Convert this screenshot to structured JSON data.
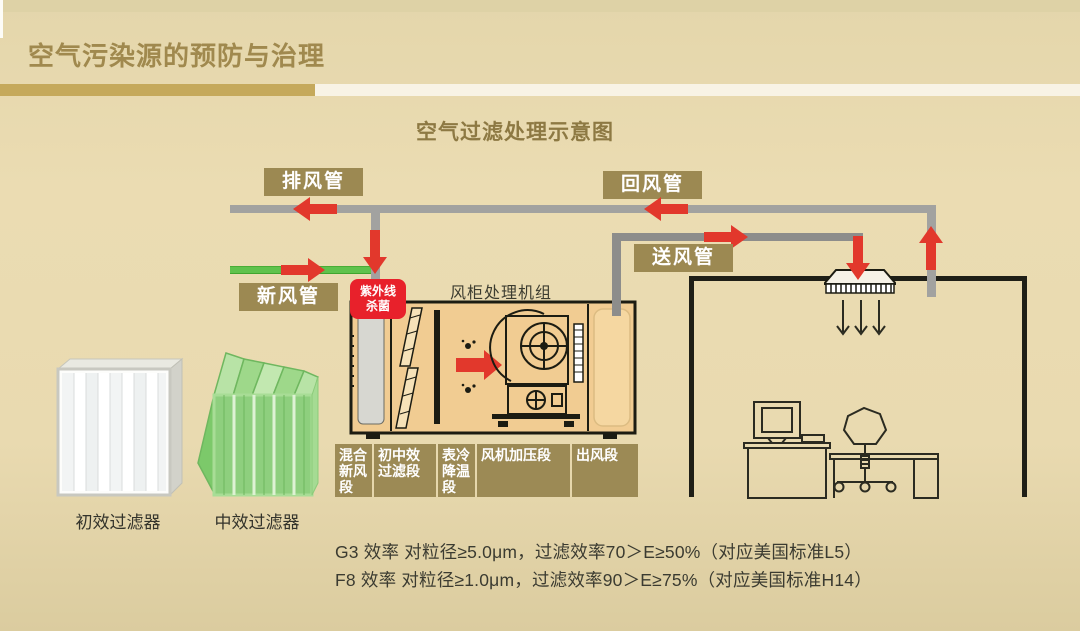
{
  "page": {
    "title": "空气污染源的预防与治理",
    "subtitle": "空气过滤处理示意图"
  },
  "ducts": {
    "exhaust": "排风管",
    "return": "回风管",
    "supply": "送风管",
    "fresh": "新风管"
  },
  "uv": {
    "line1": "紫外线",
    "line2": "杀菌"
  },
  "ahu": {
    "title": "风柜处理机组",
    "sections": [
      "混合\n新风\n段",
      "初中效\n过滤段",
      "表冷\n降温\n段",
      "风机加压段",
      "出风段"
    ]
  },
  "filters": [
    {
      "label": "初效过滤器"
    },
    {
      "label": "中效过滤器"
    }
  ],
  "notes": [
    "G3 效率 对粒径≥5.0μm，过滤效率70＞E≥50%（对应美国标准L5）",
    "F8 效率 对粒径≥1.0μm，过滤效率90＞E≥75%（对应美国标准H14）"
  ],
  "colors": {
    "background": "#e9dab0",
    "label_gold": "#9c8952",
    "bar_gold": "#c5a95b",
    "title_gold": "#a0894e",
    "arrow_red": "#e2382c",
    "uv_red": "#e8212b",
    "fresh_green": "#5fc24c",
    "duct_gray": "#a2a2a0",
    "ahu_fill": "#f1cc92"
  }
}
